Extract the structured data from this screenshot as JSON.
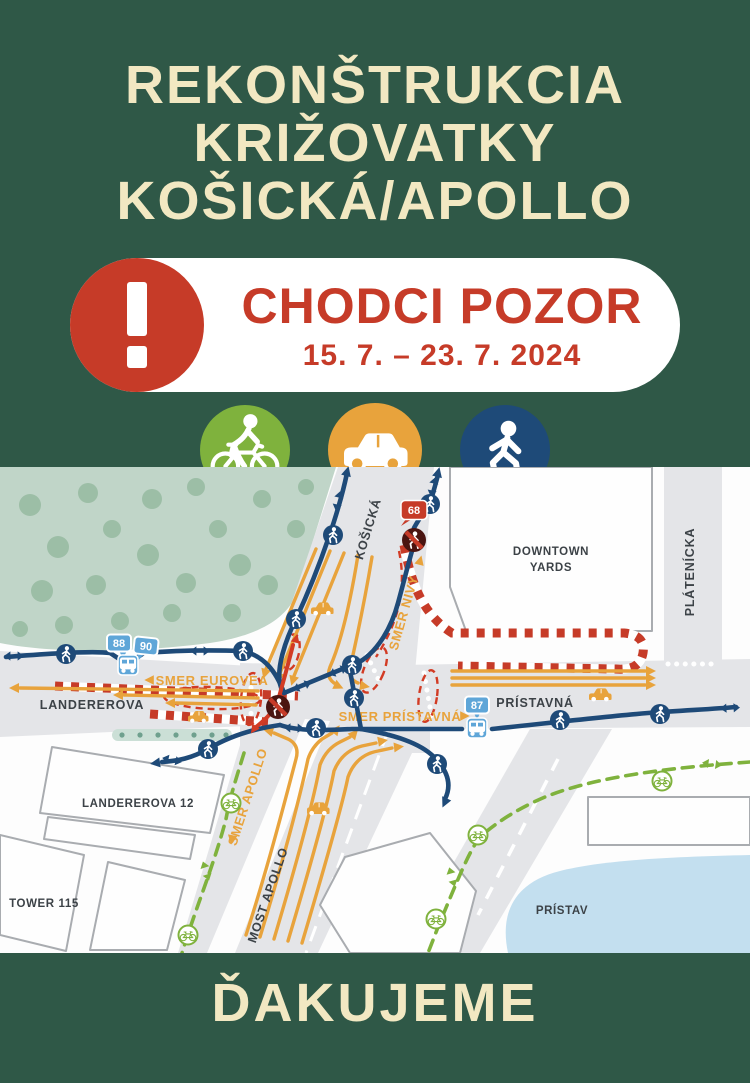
{
  "poster": {
    "background_color": "#2F5847",
    "cream_color": "#F2E8C2",
    "title_lines": [
      "REKONŠTRUKCIA",
      "KRIŽOVATKY",
      "KOŠICKÁ/APOLLO"
    ],
    "alert": {
      "icon": "exclamation-warning-icon",
      "headline": "CHODCI POZOR",
      "dates": "15. 7. – 23. 7. 2024",
      "red_color": "#C63B28"
    },
    "thanks": "ĎAKUJEME",
    "modes": [
      {
        "name": "cyclist-icon",
        "color": "#7FB23D"
      },
      {
        "name": "car-icon",
        "color": "#E8A33C"
      },
      {
        "name": "pedestrian-icon",
        "color": "#1E4A78"
      }
    ]
  },
  "map": {
    "streets": {
      "kosicka": "KOŠICKÁ",
      "landererova": "LANDEREROVA",
      "pristavna": "PRÍSTAVNÁ",
      "platenicka": "PLÁTENÍCKA",
      "most_apollo": "MOST APOLLO"
    },
    "places": {
      "downtown_yards_line1": "DOWNTOWN",
      "downtown_yards_line2": "YARDS",
      "landererova_12": "LANDEREROVA 12",
      "tower_115": "TOWER 115",
      "pristav": "PRÍSTAV"
    },
    "directions": {
      "eurovea": "SMER EUROVEA",
      "nivy": "SMER NIVY",
      "pristavna": "SMER PRÍSTAVNÁ",
      "apollo": "SMER APOLLO"
    },
    "transit": {
      "bus_stop_left_lines": [
        "88",
        "90"
      ],
      "bus_stop_right_line": "87",
      "traffic_light_number": "68"
    },
    "legend_colors": {
      "pedestrian_route": "#1E4A78",
      "car_route": "#E8A33C",
      "bike_route": "#7FB23D",
      "closure": "#C63B28",
      "water": "#C3DFEF",
      "park": "#C0D5C8",
      "road": "#E4E5E8"
    }
  }
}
